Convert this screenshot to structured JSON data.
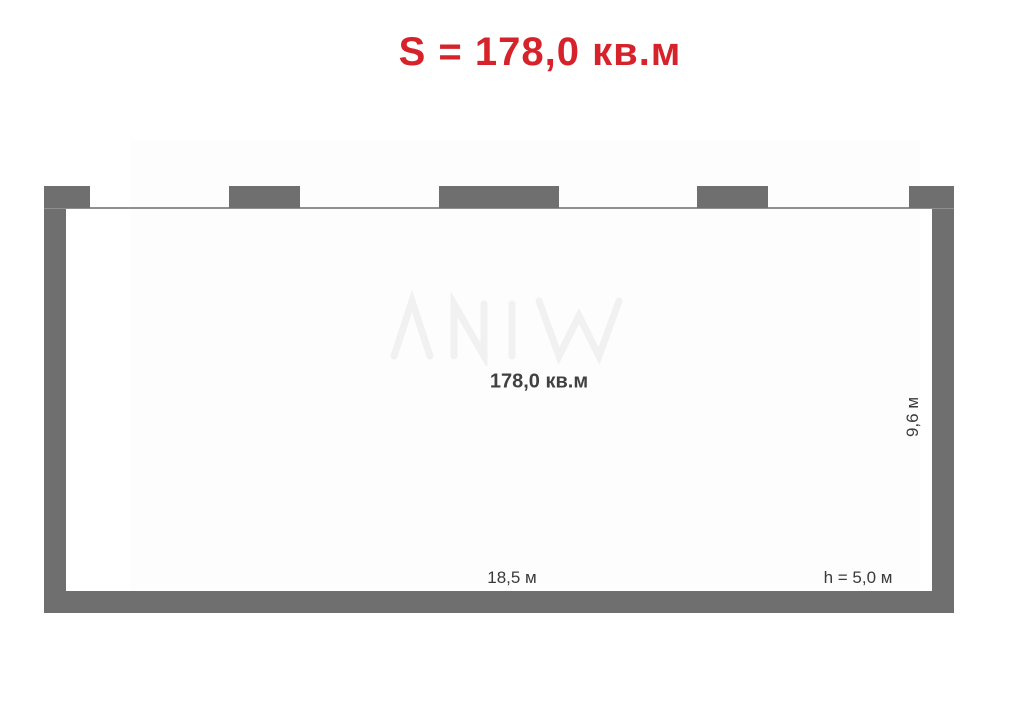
{
  "title": {
    "text": "S = 178,0 кв.м"
  },
  "room": {
    "area_label": "178,0 кв.м",
    "width_label": "18,5 м",
    "depth_label": "9,6 м",
    "ceiling_height_label": "h = 5,0 м"
  },
  "colors": {
    "accent_red": "#d6232b",
    "wall_gray": "#6f6f6f",
    "window_line_gray": "#8f8f8f",
    "dimension_text": "#3a3a3a",
    "area_text": "#414141"
  }
}
